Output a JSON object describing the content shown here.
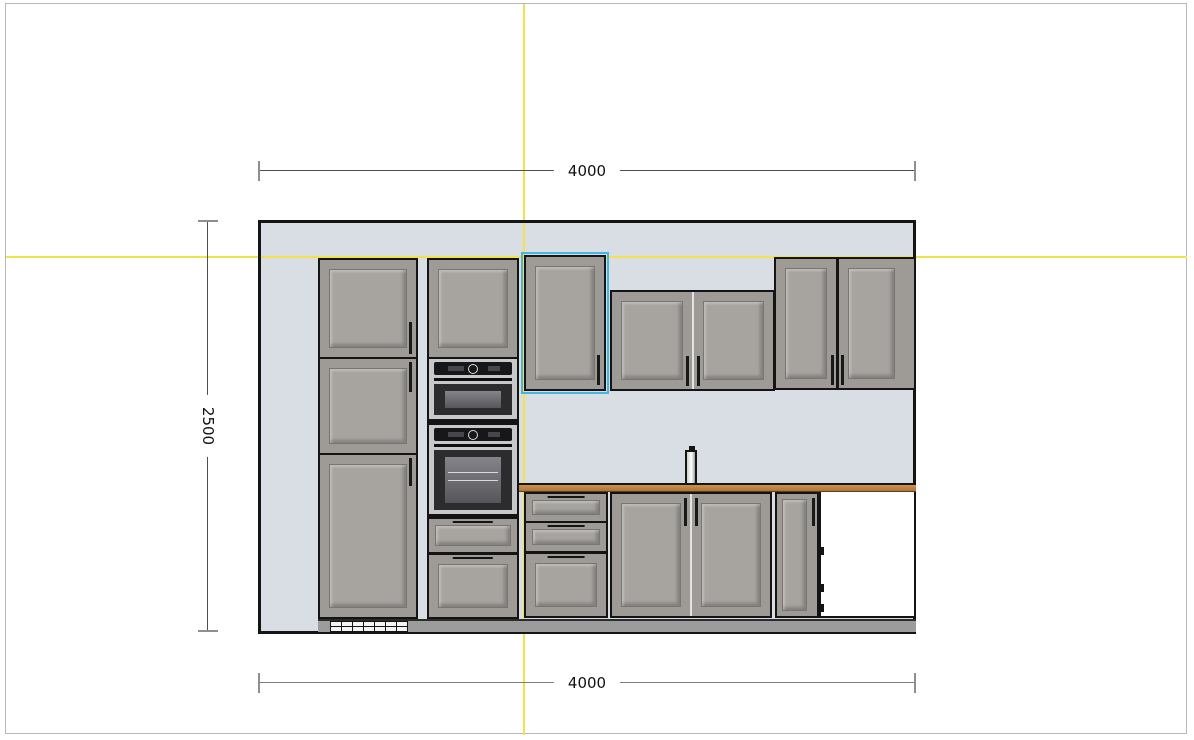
{
  "view": {
    "name": "kitchen-elevation-view",
    "selected_item": "wall-cabinet-single-door"
  },
  "dimensions": {
    "top_width_label": "4000",
    "bottom_width_label": "4000",
    "left_height_label": "2500"
  },
  "colors": {
    "guide_yellow": "#f2e24b",
    "selection": "#45b4e0",
    "wall_fill": "#d9dde4",
    "cabinet_front": "#9e9b97",
    "outline": "#141414",
    "counter_top": "#cd9148",
    "plinth": "#9c9c9c",
    "appliance_steel": "#c7c8ca",
    "dim_dark": "#4f4f4f",
    "dim_gray": "#7d7d7d",
    "page_border": "#b9b9b9"
  },
  "items": [
    "tall-cabinet-3-doors",
    "oven-tower-with-microwave-and-oven",
    "wall-cabinet-single-door-selected",
    "wall-cabinet-double-door-mid",
    "wall-cabinet-double-door-right",
    "countertop",
    "faucet",
    "base-drawer-unit-3-drawers",
    "sink-base-cabinet-double-door",
    "narrow-base-cabinet",
    "appliance-gap-open",
    "plinth-with-vent-grille"
  ]
}
